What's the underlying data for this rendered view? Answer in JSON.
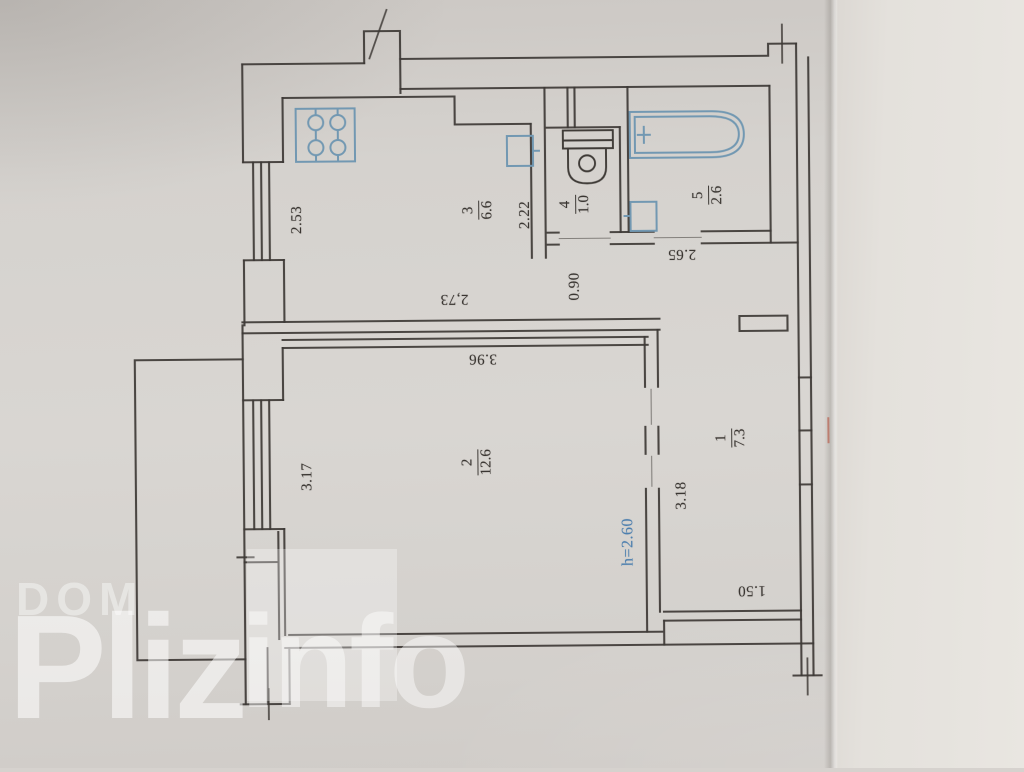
{
  "document": {
    "kind": "apartment floor plan (BTI scan, rotated 90°)",
    "units": "meters / square meters"
  },
  "watermark": {
    "line1": "DOM",
    "word_big": "Pliz",
    "word_small": "info"
  },
  "rooms": [
    {
      "number": "3",
      "area": "6.6",
      "name": "kitchen"
    },
    {
      "number": "4",
      "area": "1.0",
      "name": "wc"
    },
    {
      "number": "5",
      "area": "2.6",
      "name": "bathroom"
    },
    {
      "number": "2",
      "area": "12.6",
      "name": "living-room"
    },
    {
      "number": "1",
      "area": "7.3",
      "name": "hall"
    }
  ],
  "dims": [
    {
      "text": "2.53",
      "for": "kitchen-left-wall"
    },
    {
      "text": "2,73",
      "for": "kitchen-bottom-wall"
    },
    {
      "text": "2.22",
      "for": "kitchen-right-wall"
    },
    {
      "text": "0.90",
      "for": "corridor-width"
    },
    {
      "text": "2.65",
      "for": "corridor-length"
    },
    {
      "text": "3.96",
      "for": "living-room-top-wall"
    },
    {
      "text": "3.17",
      "for": "living-room-left-wall"
    },
    {
      "text": "h=2.60",
      "for": "ceiling-height"
    },
    {
      "text": "3.18",
      "for": "hall-left-wall"
    },
    {
      "text": "1.50",
      "for": "hall-bottom-wall"
    }
  ],
  "fixtures": [
    "stove",
    "kitchen-sink",
    "toilet",
    "bathtub",
    "washbasin"
  ],
  "colors": {
    "paper": "#d6d2ce",
    "background_right": "#e6e3de",
    "line": "#3e3a36",
    "fixture_blue": "#7298b2",
    "dim_text": "#3a3632",
    "height_text": "#4d7fae",
    "red_mark": "#b85948",
    "watermark": "#ffffff"
  }
}
